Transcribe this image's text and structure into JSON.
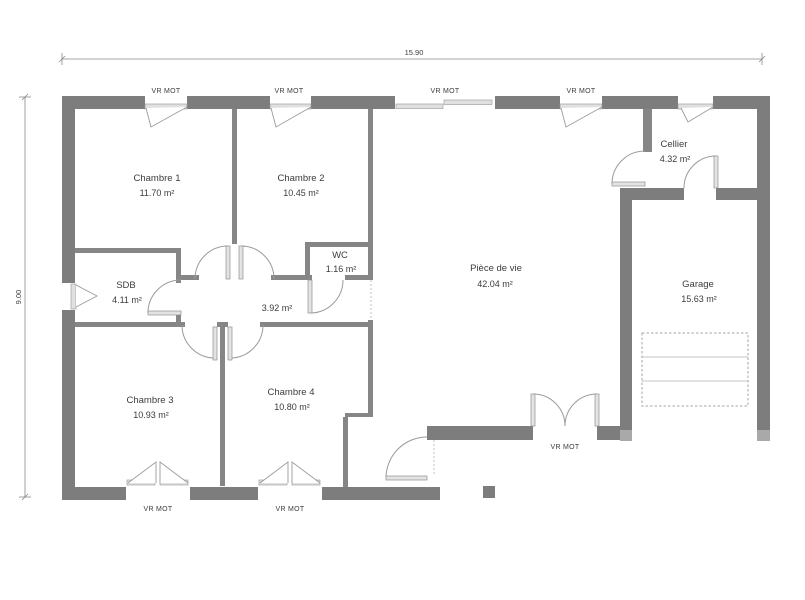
{
  "plan": {
    "type": "floor-plan",
    "dimensions": {
      "width_m": "15.90",
      "height_m": "9.00"
    },
    "labels": {
      "vr_mot": "VR MOT"
    },
    "rooms": {
      "chambre1": {
        "name": "Chambre 1",
        "area": "11.70 m²"
      },
      "chambre2": {
        "name": "Chambre 2",
        "area": "10.45 m²"
      },
      "wc": {
        "name": "WC",
        "area": "1.16 m²"
      },
      "sdb": {
        "name": "SDB",
        "area": "4.11 m²"
      },
      "degagement": {
        "name": "",
        "area": "3.92 m²"
      },
      "chambre3": {
        "name": "Chambre 3",
        "area": "10.93 m²"
      },
      "chambre4": {
        "name": "Chambre 4",
        "area": "10.80 m²"
      },
      "piece_de_vie": {
        "name": "Pièce de vie",
        "area": "42.04 m²"
      },
      "cellier": {
        "name": "Cellier",
        "area": "4.32 m²"
      },
      "garage": {
        "name": "Garage",
        "area": "15.63 m²"
      }
    },
    "colors": {
      "wall": "#7d7d7d",
      "wall_interior": "#868686",
      "wall_cap": "#a9a9a9",
      "line": "#9b9b9b",
      "text": "#3c3c3c"
    }
  }
}
